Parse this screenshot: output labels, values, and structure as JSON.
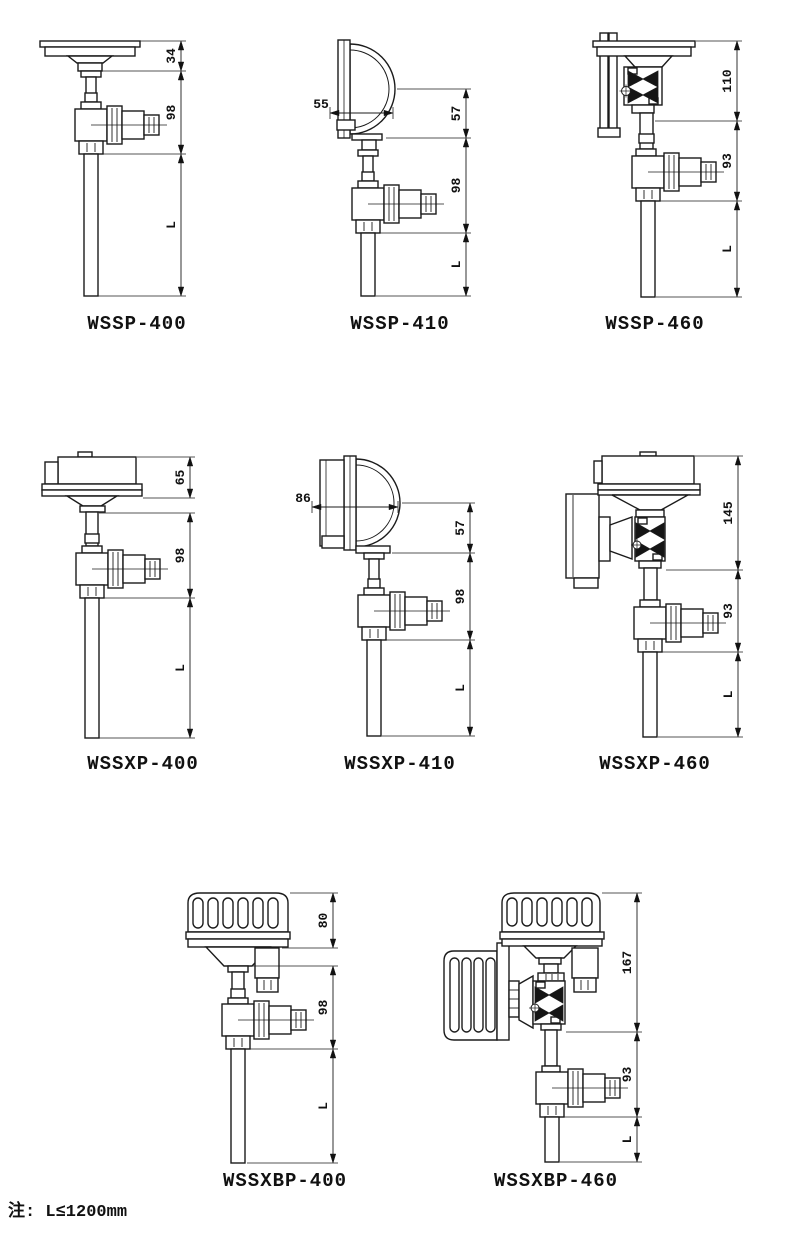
{
  "note": "注: L≤1200mm",
  "colors": {
    "line": "#1b1b1b",
    "background": "#ffffff"
  },
  "figures": [
    {
      "id": "wssp-400",
      "label": "WSSP-400",
      "segments": [
        "34",
        "98",
        "L"
      ]
    },
    {
      "id": "wssp-410",
      "label": "WSSP-410",
      "segments": [
        "57",
        "98",
        "L"
      ],
      "depth": "55"
    },
    {
      "id": "wssp-460",
      "label": "WSSP-460",
      "segments": [
        "110",
        "93",
        "L"
      ]
    },
    {
      "id": "wssxp-400",
      "label": "WSSXP-400",
      "segments": [
        "65",
        "98",
        "L"
      ]
    },
    {
      "id": "wssxp-410",
      "label": "WSSXP-410",
      "segments": [
        "57",
        "98",
        "L"
      ],
      "depth": "86"
    },
    {
      "id": "wssxp-460",
      "label": "WSSXP-460",
      "segments": [
        "145",
        "93",
        "L"
      ]
    },
    {
      "id": "wssxbp-400",
      "label": "WSSXBP-400",
      "segments": [
        "80",
        "98",
        "L"
      ]
    },
    {
      "id": "wssxbp-460",
      "label": "WSSXBP-460",
      "segments": [
        "167",
        "93",
        "L"
      ]
    }
  ]
}
